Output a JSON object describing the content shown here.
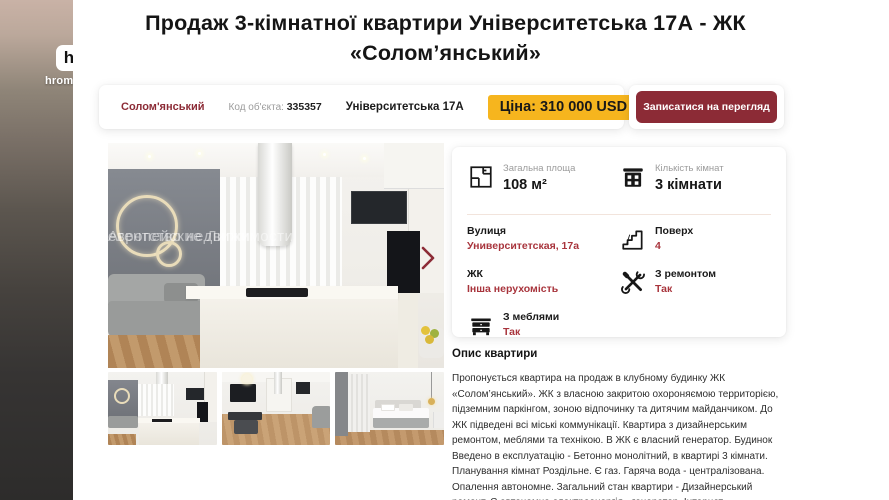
{
  "channel_watermark": {
    "initial": "h",
    "name": "hromadske"
  },
  "header": {
    "title_line1": "Продаж 3-кімнатної квартири Університетська 17А - ЖК",
    "title_line2": "«Солом’янський»"
  },
  "badges": {
    "district": "Солом'янський",
    "code_label": "Код об'єкта:",
    "code_value": "335357",
    "address": "Університетська 17А",
    "price": "Ціна: 310 000 USD"
  },
  "cta": {
    "label": "Записатися на перегляд"
  },
  "gallery": {
    "watermark_line1": "Агентство недвижимости",
    "watermark_line2": "европейские Липки"
  },
  "details": {
    "rows": [
      {
        "label": "Загальна площа",
        "value": "108 м²",
        "icon": "floorplan-icon"
      },
      {
        "label": "Кількість кімнат",
        "value": "3 кімнати",
        "icon": "building-icon"
      },
      {
        "label": "Вулиця",
        "value": "Университетская, 17а",
        "icon": null
      },
      {
        "label": "Поверх",
        "value": "4",
        "icon": "stairs-icon"
      },
      {
        "label": "ЖК",
        "value": "Інша нерухомість",
        "icon": null
      },
      {
        "label": "З ремонтом",
        "value": "Так",
        "icon": "tools-icon"
      },
      {
        "label": "З меблями",
        "value": "Так",
        "icon": "furniture-icon"
      }
    ]
  },
  "description": {
    "heading": "Опис квартири",
    "text": "Пропонується квартира на продаж в клубному будинку ЖК «Солом’янський». ЖК з власною закритою охороняємою территорією, підземним паркінгом, зоною відпочинку та дитячим майданчиком. До ЖК підведені всі міські коммунікації. Квартира з дизайнерським ремонтом, меблями та технікою. В ЖК є власний генератор. Будинок Введено в експлуатацію - Бетонно монолітний, в квартирі 3 кімнати. Планування кімнат Роздільне. Є газ. Гаряча вода - централізована. Опалення автономне. Загальний стан квартири - Дизайнерський ремонт. Є автономна електроенергія - генератор. Інтернет"
  },
  "colors": {
    "accent_maroon": "#8C2B36",
    "price_yellow": "#F6B51E",
    "value_red": "#A8343C"
  }
}
